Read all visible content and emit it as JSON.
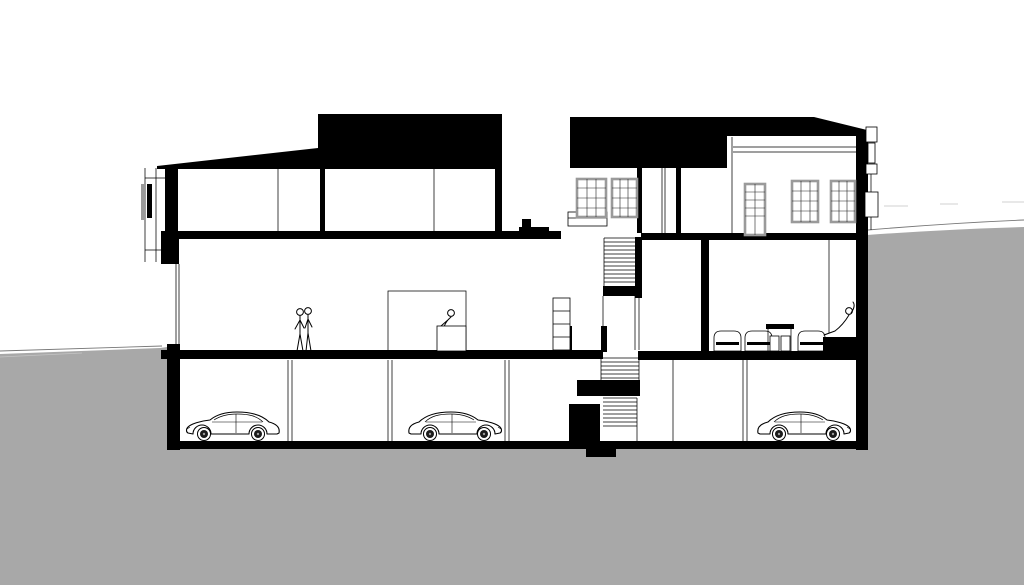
{
  "image": {
    "kind": "architectural cross-section drawing",
    "visible_text": "none"
  },
  "colors": {
    "paper": "#ffffff",
    "ink": "#000000",
    "terrain": "#a8a8a8",
    "window_frame": "#9a9a9a",
    "panel_gray": "#9a9a9a"
  },
  "scene": {
    "levels": [
      "upper-floor",
      "main-floor",
      "basement-parking"
    ],
    "basement_cars": 3,
    "stair_tower_windows": 2,
    "right_wing_windows": 2,
    "right_wing_doors": 1,
    "people": {
      "standing_couple": 2,
      "reception_seated": 1,
      "lounge_seated": 1
    },
    "site": "ground level low at left, terrain rises to right of building"
  }
}
